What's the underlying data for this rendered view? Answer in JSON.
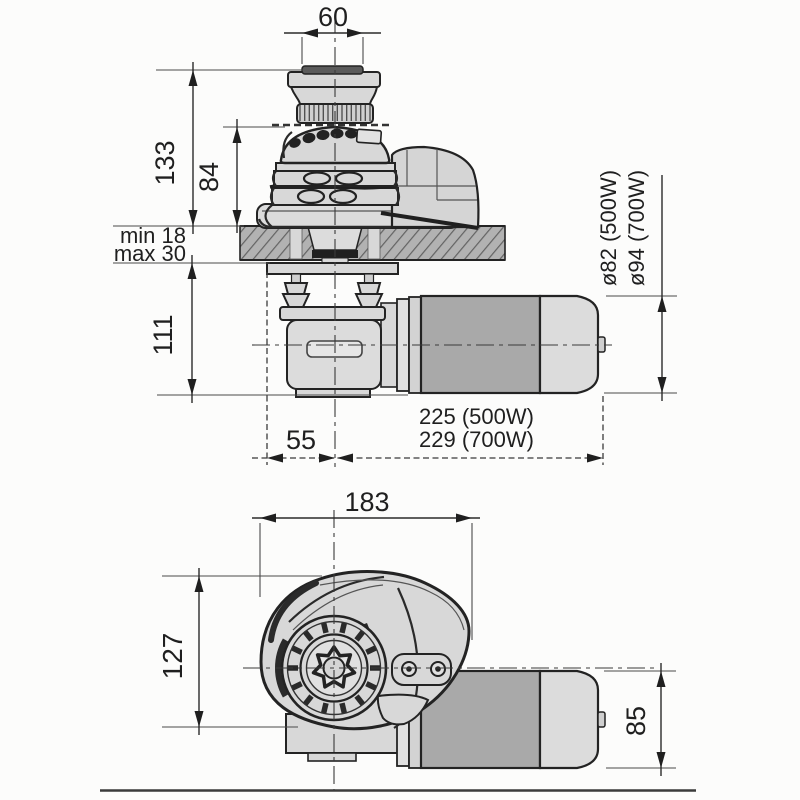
{
  "drawing": {
    "type": "technical-dimension-drawing",
    "subject": "anchor windlass with gypsy, capstan and motor — side section view and plan view",
    "side_view": {
      "dim_capstan_width": "60",
      "dim_height_above_deck": "133",
      "dim_gypsy_height": "84",
      "dim_deck_min": "min 18",
      "dim_deck_max": "max 30",
      "dim_below_deck": "111",
      "dim_center_to_edge": "55",
      "dim_length_500w": "225 (500W)",
      "dim_length_700w": "229 (700W)",
      "dim_motor_dia_500w": "ø82 (500W)",
      "dim_motor_dia_700w": "ø94 (700W)"
    },
    "plan_view": {
      "dim_body_width": "183",
      "dim_body_depth": "127",
      "dim_motor_height": "85"
    },
    "colors": {
      "line": "#2b2b2b",
      "body_fill": "#d8d8d8",
      "motor_dark": "#a9a9a9",
      "motor_light": "#dcdcdc",
      "deck_fill": "#b2b2b2",
      "hatch_line": "#636363"
    }
  }
}
